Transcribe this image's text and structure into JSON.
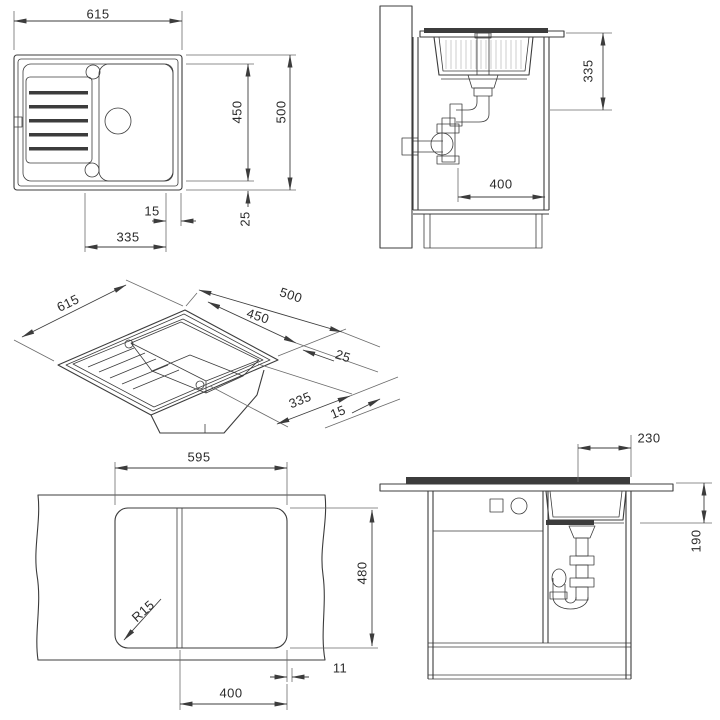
{
  "style": {
    "ink": "#3c3c3c",
    "background": "#ffffff"
  },
  "views": {
    "plan": {
      "dims": {
        "overall_width": "615",
        "inner_depth": "450",
        "overall_depth": "500",
        "edge_gap": "15",
        "rim_inset": "25",
        "bowl_width": "335"
      }
    },
    "side_section": {
      "dims": {
        "install_depth": "335",
        "drain_offset": "400"
      }
    },
    "isometric": {
      "dims": {
        "overall_width": "615",
        "overall_depth": "500",
        "inner_depth": "450",
        "rim_inset": "25",
        "bowl_width": "335",
        "edge_gap": "15"
      }
    },
    "cutout": {
      "dims": {
        "cutout_width": "595",
        "cutout_depth": "480",
        "corner_radius": "R15",
        "reveal": "11",
        "bowl_cutout": "400"
      }
    },
    "front_section": {
      "dims": {
        "bowl_width": "230",
        "bowl_depth": "190"
      }
    }
  }
}
